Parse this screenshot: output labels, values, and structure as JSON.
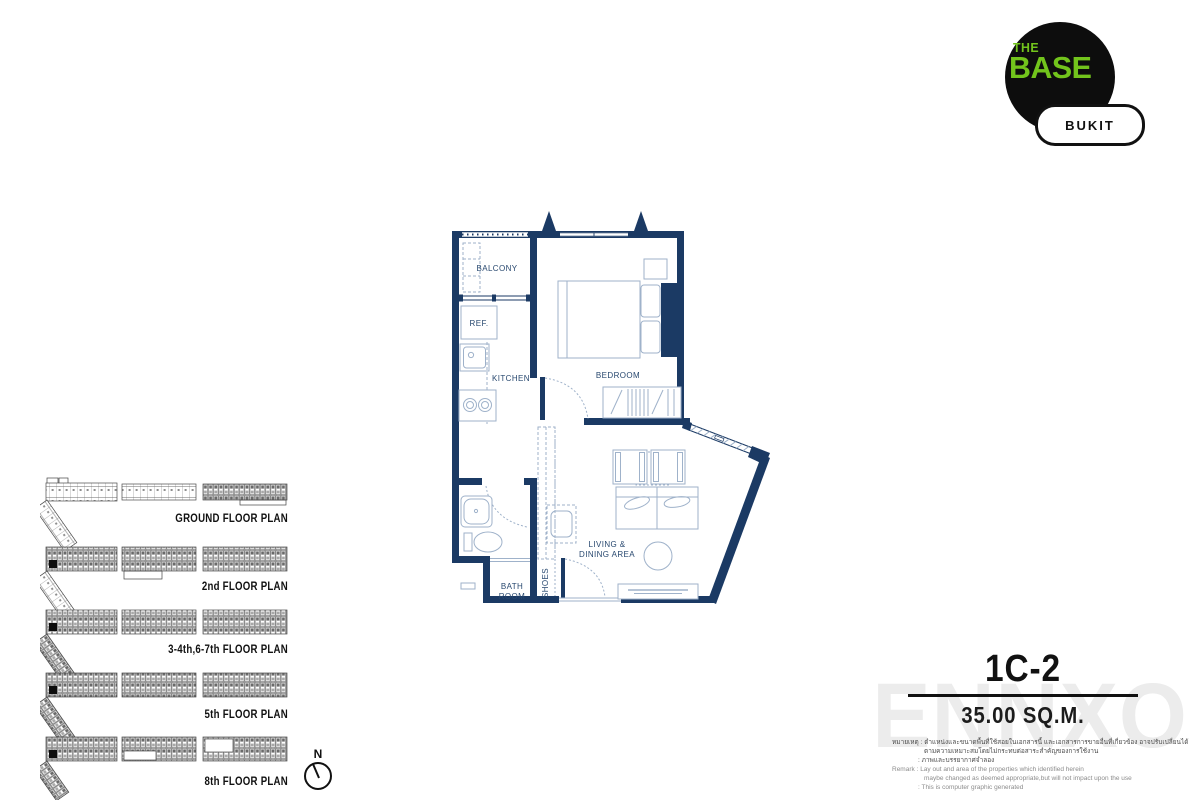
{
  "logo": {
    "line1": "THE",
    "line2": "BASE",
    "badge": "BUKIT",
    "green": "#72c41c",
    "circle_color": "#0d0d0d"
  },
  "unit": {
    "code": "1C-2",
    "area": "35.00  SQ.M."
  },
  "watermark": "ENNXO",
  "compass": {
    "label": "N"
  },
  "plan_labels": {
    "balcony": "BALCONY",
    "ref": "REF.",
    "kitchen": "KITCHEN",
    "bedroom": "BEDROOM",
    "bath_line1": "BATH",
    "bath_line2": "ROOM",
    "shoes": "SHOES",
    "living_line1": "LIVING &",
    "living_line2": "DINING AREA"
  },
  "floor_plans": [
    {
      "label": "GROUND  FLOOR PLAN",
      "highlighted": false
    },
    {
      "label": "2nd  FLOOR PLAN",
      "highlighted": true
    },
    {
      "label": "3-4th,6-7th  FLOOR PLAN",
      "highlighted": true
    },
    {
      "label": "5th  FLOOR PLAN",
      "highlighted": true
    },
    {
      "label": "8th  FLOOR PLAN",
      "highlighted": true
    }
  ],
  "disclaimer": {
    "thai_label": "หมายเหตุ",
    "thai_line1": ": ตำแหน่งและขนาดพื้นที่ใช้สอยในเอกสารนี้ และเอกสารการขายอื่นที่เกี่ยวข้อง อาจปรับเปลี่ยนได้",
    "thai_line2": "ตามความเหมาะสมโดยไม่กระทบต่อสาระสำคัญของการใช้งาน",
    "thai_line3": ": ภาพและบรรยากาศจำลอง",
    "remark_label": "Remark",
    "remark_line1": ": Lay out and area of the properties which identified herein",
    "remark_line2": "maybe changed as deemed appropriate,but will not impact upon the use",
    "remark_line3": ": This is computer graphic generated"
  },
  "colors": {
    "wall_navy": "#1b3a64",
    "furniture_blue": "#9fb2ca",
    "label_navy": "#28486f",
    "watermark_gray": "#ececec"
  }
}
